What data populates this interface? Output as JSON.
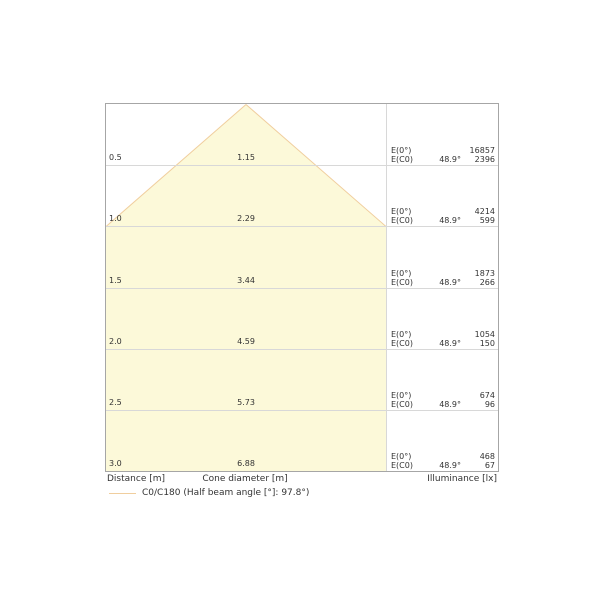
{
  "chart_data": {
    "type": "area",
    "title": "Luminaire light cone diagram",
    "xlabel_left": "Distance [m]",
    "xlabel_center": "Cone diameter [m]",
    "xlabel_right": "Illuminance [lx]",
    "legend": {
      "label": "C0/C180 (Half beam angle [°]: 97.8°)",
      "swatch_color": "#f0ce9e"
    },
    "cone": {
      "fill": "#fcf9d9",
      "stroke": "#f0ce9e",
      "apex_distance_m": 0,
      "meters_per_panel_halfwidth": 1.145
    },
    "axis": {
      "distance_range_m": [
        0,
        3.0
      ],
      "grid": true
    },
    "rows": [
      {
        "distance": "0.5",
        "diameter": "1.15",
        "e0_label": "E(0°)",
        "ec0_label": "E(C0)",
        "angle": "48.9°",
        "e0": "16857",
        "ec0": "2396"
      },
      {
        "distance": "1.0",
        "diameter": "2.29",
        "e0_label": "E(0°)",
        "ec0_label": "E(C0)",
        "angle": "48.9°",
        "e0": "4214",
        "ec0": "599"
      },
      {
        "distance": "1.5",
        "diameter": "3.44",
        "e0_label": "E(0°)",
        "ec0_label": "E(C0)",
        "angle": "48.9°",
        "e0": "1873",
        "ec0": "266"
      },
      {
        "distance": "2.0",
        "diameter": "4.59",
        "e0_label": "E(0°)",
        "ec0_label": "E(C0)",
        "angle": "48.9°",
        "e0": "1054",
        "ec0": "150"
      },
      {
        "distance": "2.5",
        "diameter": "5.73",
        "e0_label": "E(0°)",
        "ec0_label": "E(C0)",
        "angle": "48.9°",
        "e0": "674",
        "ec0": "96"
      },
      {
        "distance": "3.0",
        "diameter": "6.88",
        "e0_label": "E(0°)",
        "ec0_label": "E(C0)",
        "angle": "48.9°",
        "e0": "468",
        "ec0": "67"
      }
    ]
  }
}
